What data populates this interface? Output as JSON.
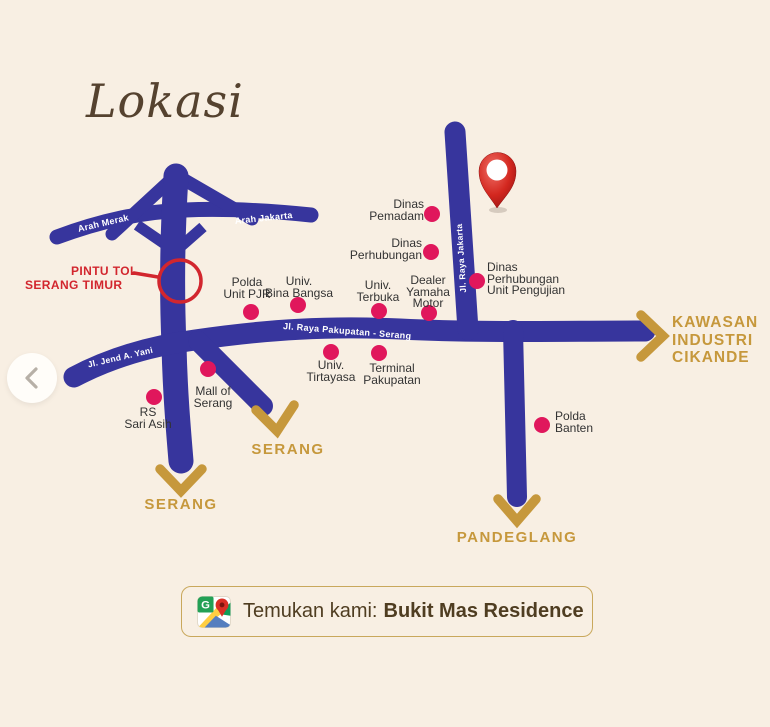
{
  "page": {
    "background": "#f8efe3"
  },
  "title": {
    "text": "Lokasi"
  },
  "carousel": {
    "icon": "chevron-left"
  },
  "palette": {
    "road_blue": "#37359d",
    "dot_pink": "#e0175c",
    "gold": "#c6983c",
    "alert_red": "#d2262e",
    "label_ink": "#333333",
    "footer_brown": "#4f3d21",
    "footer_border": "#c9a85c"
  },
  "map": {
    "road_labels": {
      "arah_merak": "Arah Merak",
      "arah_jakarta": "Arah Jakarta",
      "jl_raya_jakarta": "Jl. Raya Jakarta",
      "jl_raya_pakupatan": "Jl. Raya Pakupatan - Serang",
      "jl_jend_a_yani": "Jl. Jend A. Yani"
    },
    "toll_gate": {
      "line1": "PINTU TOL",
      "line2": "SERANG TIMUR"
    },
    "marker": {
      "icon": "map-pin"
    },
    "locations": [
      {
        "id": "dinas-pemadam",
        "lines": [
          "Dinas",
          "Pemadam"
        ]
      },
      {
        "id": "dinas-perhubungan",
        "lines": [
          "Dinas",
          "Perhubungan"
        ]
      },
      {
        "id": "dinas-perhubungan-unit-pengujian",
        "lines": [
          "Dinas",
          "Perhubungan",
          "Unit Pengujian"
        ]
      },
      {
        "id": "polda-unit-pjr",
        "lines": [
          "Polda",
          "Unit PJR"
        ]
      },
      {
        "id": "univ-bina-bangsa",
        "lines": [
          "Univ.",
          "Bina Bangsa"
        ]
      },
      {
        "id": "univ-terbuka",
        "lines": [
          "Univ.",
          "Terbuka"
        ]
      },
      {
        "id": "dealer-yamaha-motor",
        "lines": [
          "Dealer",
          "Yamaha",
          "Motor"
        ]
      },
      {
        "id": "univ-tirtayasa",
        "lines": [
          "Univ.",
          "Tirtayasa"
        ]
      },
      {
        "id": "terminal-pakupatan",
        "lines": [
          "Terminal",
          "Pakupatan"
        ]
      },
      {
        "id": "mall-of-serang",
        "lines": [
          "Mall of",
          "Serang"
        ]
      },
      {
        "id": "rs-sari-asih",
        "lines": [
          "RS",
          "Sari Asih"
        ]
      },
      {
        "id": "polda-banten",
        "lines": [
          "Polda",
          "Banten"
        ]
      }
    ],
    "directions": {
      "serang_a": "SERANG",
      "serang_b": "SERANG",
      "pandeglang": "PANDEGLANG",
      "kawasan": {
        "line1": "KAWASAN",
        "line2": "INDUSTRI",
        "line3": "CIKANDE"
      }
    }
  },
  "footer": {
    "icon": "google-maps-icon",
    "g_letter": "G",
    "prefix": "Temukan kami:",
    "name": "Bukit Mas Residence"
  }
}
